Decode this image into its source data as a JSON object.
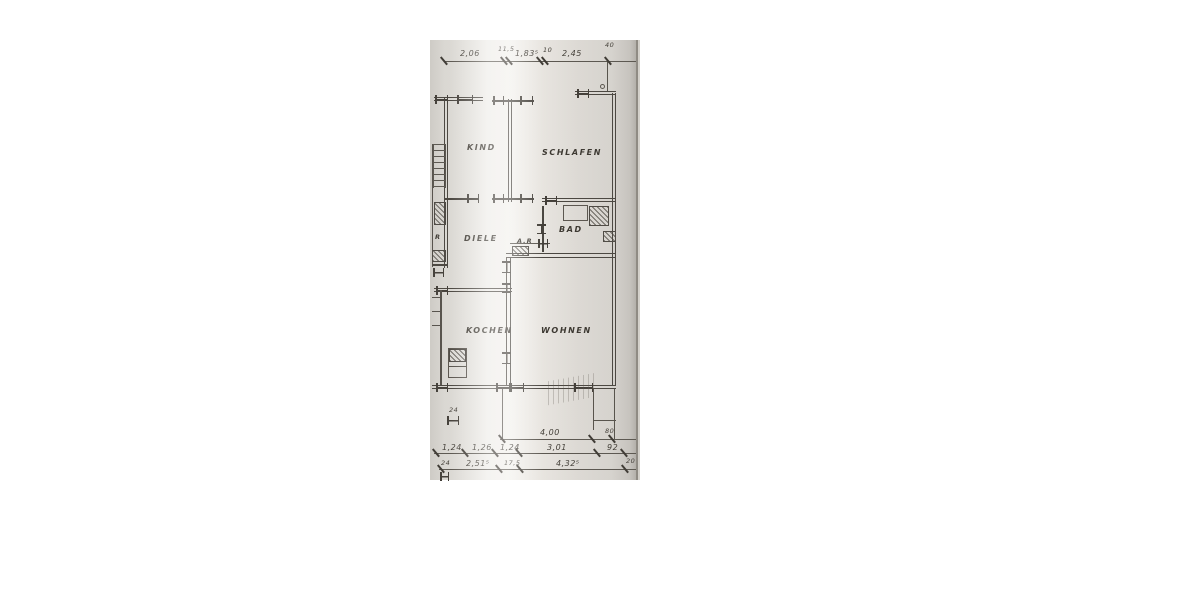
{
  "plan": {
    "rooms": {
      "kind": "KIND",
      "schlafen": "SCHLAFEN",
      "diele": "DIELE",
      "bad": "BAD",
      "ar": "A.R",
      "r": "R",
      "kochen": "KOCHEN",
      "wohnen": "WOHNEN"
    },
    "dims": {
      "top": [
        "2,06",
        "11,5",
        "1,83⁵",
        "10",
        "2,45",
        "40"
      ],
      "mid": [
        "4,00",
        "80"
      ],
      "row2": [
        "1,24",
        "1,26",
        "1,24",
        "3,01",
        "92"
      ],
      "row3": [
        "24",
        "2,51⁵",
        "17,5",
        "4,32⁵",
        "20"
      ],
      "sill": "24"
    },
    "line_color": "#48443e",
    "paper_color": "#edebe7"
  }
}
